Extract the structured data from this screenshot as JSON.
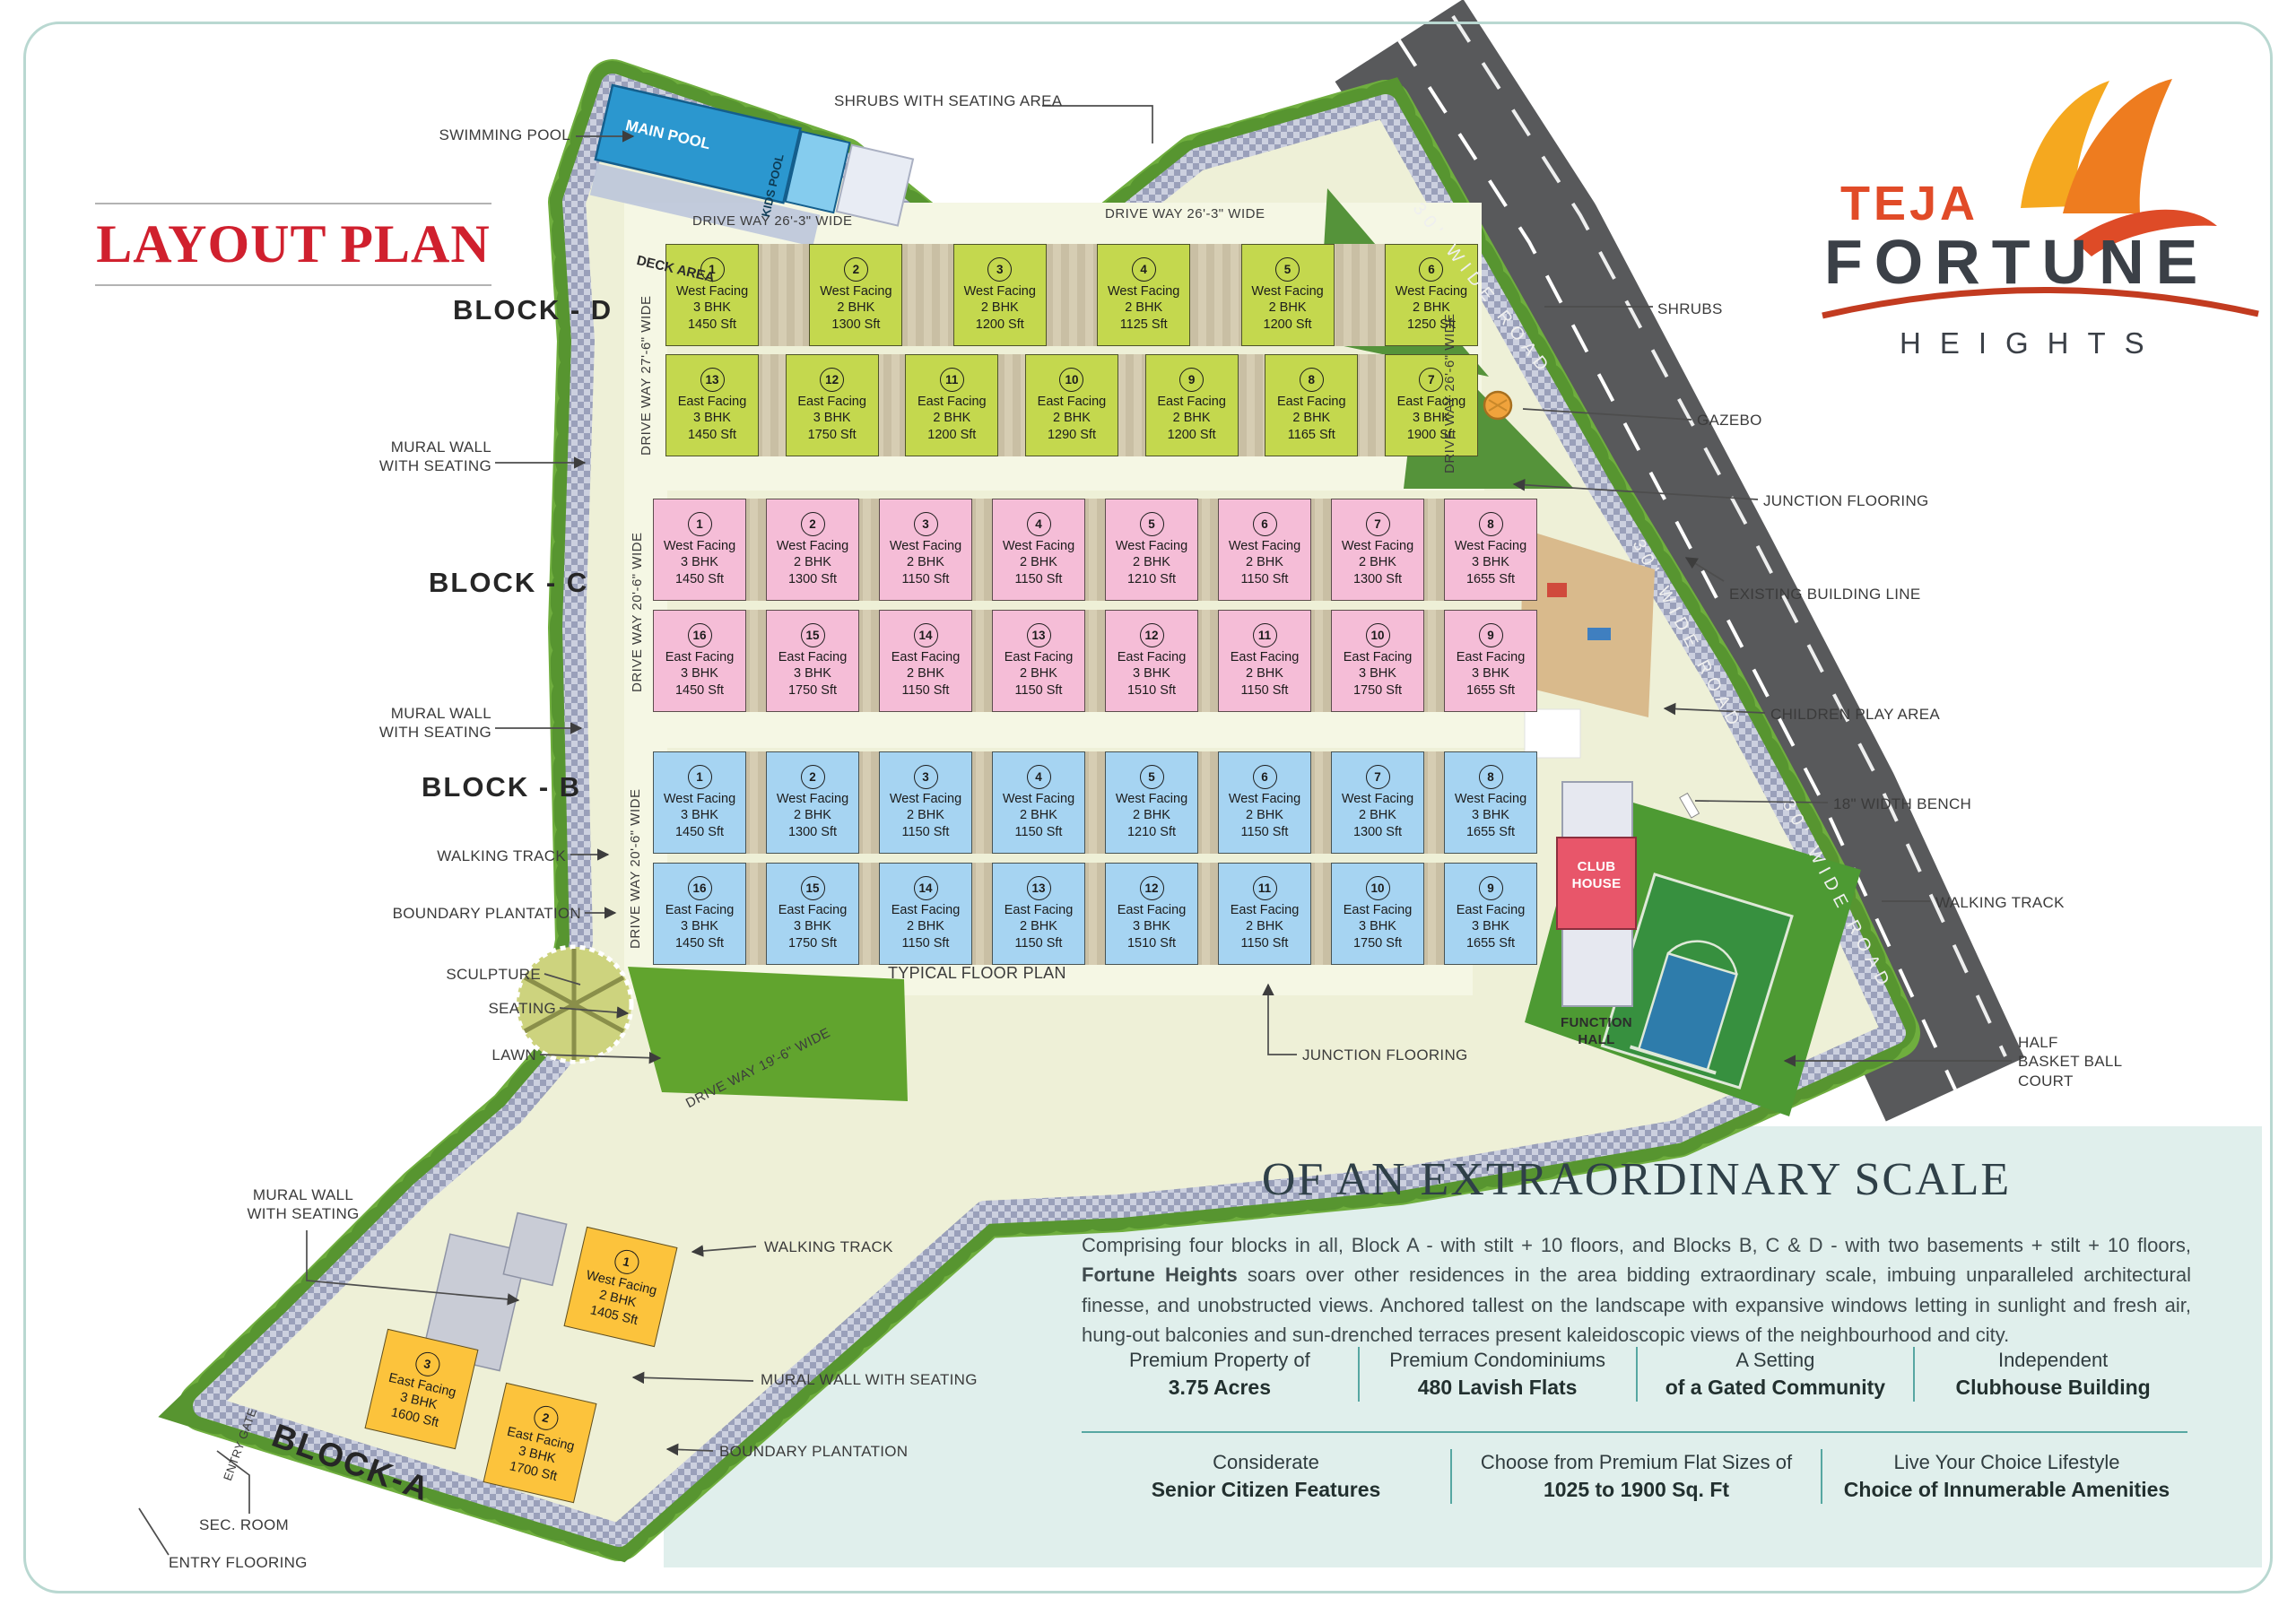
{
  "brand": {
    "teja": "TEJA",
    "fortune": "FORTUNE",
    "heights": "HEIGHTS"
  },
  "title": "LAYOUT PLAN",
  "pool": {
    "callout": "SWIMMING POOL",
    "main": "MAIN POOL",
    "kids": "KIDS POOL",
    "deck": "DECK AREA"
  },
  "driveways": {
    "top1": "DRIVE WAY 26'-3\" WIDE",
    "top2": "DRIVE WAY 26'-3\" WIDE",
    "d_left": "DRIVE WAY 27'-6\" WIDE",
    "d_right": "DRIVE WAY 26'-6\" WIDE",
    "c_left": "DRIVE WAY 20'-6\" WIDE",
    "b_left": "DRIVE WAY 20'-6\" WIDE",
    "bottom": "DRIVE WAY 19'-6\" WIDE"
  },
  "roads": {
    "r1": "30' WIDE ROAD",
    "r2": "30' WIDE ROAD",
    "r3": "30' WIDE ROAD"
  },
  "blocks": {
    "d": {
      "label": "BLOCK - D",
      "row1": [
        {
          "no": "1",
          "facing": "West Facing",
          "bhk": "3 BHK",
          "area": "1450 Sft"
        },
        {
          "no": "2",
          "facing": "West Facing",
          "bhk": "2 BHK",
          "area": "1300 Sft"
        },
        {
          "no": "3",
          "facing": "West Facing",
          "bhk": "2 BHK",
          "area": "1200 Sft"
        },
        {
          "no": "4",
          "facing": "West Facing",
          "bhk": "2 BHK",
          "area": "1125 Sft"
        },
        {
          "no": "5",
          "facing": "West Facing",
          "bhk": "2 BHK",
          "area": "1200 Sft"
        },
        {
          "no": "6",
          "facing": "West Facing",
          "bhk": "2 BHK",
          "area": "1250 Sft"
        }
      ],
      "row2": [
        {
          "no": "13",
          "facing": "East Facing",
          "bhk": "3 BHK",
          "area": "1450 Sft"
        },
        {
          "no": "12",
          "facing": "East Facing",
          "bhk": "3 BHK",
          "area": "1750 Sft"
        },
        {
          "no": "11",
          "facing": "East Facing",
          "bhk": "2 BHK",
          "area": "1200 Sft"
        },
        {
          "no": "10",
          "facing": "East Facing",
          "bhk": "2 BHK",
          "area": "1290 Sft"
        },
        {
          "no": "9",
          "facing": "East Facing",
          "bhk": "2 BHK",
          "area": "1200 Sft"
        },
        {
          "no": "8",
          "facing": "East Facing",
          "bhk": "2 BHK",
          "area": "1165 Sft"
        },
        {
          "no": "7",
          "facing": "East Facing",
          "bhk": "3 BHK",
          "area": "1900 Sft"
        }
      ]
    },
    "c": {
      "label": "BLOCK - C",
      "row1": [
        {
          "no": "1",
          "facing": "West Facing",
          "bhk": "3 BHK",
          "area": "1450 Sft"
        },
        {
          "no": "2",
          "facing": "West Facing",
          "bhk": "2 BHK",
          "area": "1300 Sft"
        },
        {
          "no": "3",
          "facing": "West Facing",
          "bhk": "2 BHK",
          "area": "1150 Sft"
        },
        {
          "no": "4",
          "facing": "West Facing",
          "bhk": "2 BHK",
          "area": "1150 Sft"
        },
        {
          "no": "5",
          "facing": "West Facing",
          "bhk": "2 BHK",
          "area": "1210 Sft"
        },
        {
          "no": "6",
          "facing": "West Facing",
          "bhk": "2 BHK",
          "area": "1150 Sft"
        },
        {
          "no": "7",
          "facing": "West Facing",
          "bhk": "2 BHK",
          "area": "1300 Sft"
        },
        {
          "no": "8",
          "facing": "West Facing",
          "bhk": "3 BHK",
          "area": "1655 Sft"
        }
      ],
      "row2": [
        {
          "no": "16",
          "facing": "East Facing",
          "bhk": "3 BHK",
          "area": "1450 Sft"
        },
        {
          "no": "15",
          "facing": "East Facing",
          "bhk": "3 BHK",
          "area": "1750 Sft"
        },
        {
          "no": "14",
          "facing": "East Facing",
          "bhk": "2 BHK",
          "area": "1150 Sft"
        },
        {
          "no": "13",
          "facing": "East Facing",
          "bhk": "2 BHK",
          "area": "1150 Sft"
        },
        {
          "no": "12",
          "facing": "East Facing",
          "bhk": "3 BHK",
          "area": "1510 Sft"
        },
        {
          "no": "11",
          "facing": "East Facing",
          "bhk": "2 BHK",
          "area": "1150 Sft"
        },
        {
          "no": "10",
          "facing": "East Facing",
          "bhk": "3 BHK",
          "area": "1750 Sft"
        },
        {
          "no": "9",
          "facing": "East Facing",
          "bhk": "3 BHK",
          "area": "1655 Sft"
        }
      ]
    },
    "b": {
      "label": "BLOCK - B",
      "row1": [
        {
          "no": "1",
          "facing": "West Facing",
          "bhk": "3 BHK",
          "area": "1450 Sft"
        },
        {
          "no": "2",
          "facing": "West Facing",
          "bhk": "2 BHK",
          "area": "1300 Sft"
        },
        {
          "no": "3",
          "facing": "West Facing",
          "bhk": "2 BHK",
          "area": "1150 Sft"
        },
        {
          "no": "4",
          "facing": "West Facing",
          "bhk": "2 BHK",
          "area": "1150 Sft"
        },
        {
          "no": "5",
          "facing": "West Facing",
          "bhk": "2 BHK",
          "area": "1210 Sft"
        },
        {
          "no": "6",
          "facing": "West Facing",
          "bhk": "2 BHK",
          "area": "1150 Sft"
        },
        {
          "no": "7",
          "facing": "West Facing",
          "bhk": "2 BHK",
          "area": "1300 Sft"
        },
        {
          "no": "8",
          "facing": "West Facing",
          "bhk": "3 BHK",
          "area": "1655 Sft"
        }
      ],
      "row2": [
        {
          "no": "16",
          "facing": "East Facing",
          "bhk": "3 BHK",
          "area": "1450 Sft"
        },
        {
          "no": "15",
          "facing": "East Facing",
          "bhk": "3 BHK",
          "area": "1750 Sft"
        },
        {
          "no": "14",
          "facing": "East Facing",
          "bhk": "2 BHK",
          "area": "1150 Sft"
        },
        {
          "no": "13",
          "facing": "East Facing",
          "bhk": "2 BHK",
          "area": "1150 Sft"
        },
        {
          "no": "12",
          "facing": "East Facing",
          "bhk": "3 BHK",
          "area": "1510 Sft"
        },
        {
          "no": "11",
          "facing": "East Facing",
          "bhk": "2 BHK",
          "area": "1150 Sft"
        },
        {
          "no": "10",
          "facing": "East Facing",
          "bhk": "3 BHK",
          "area": "1750 Sft"
        },
        {
          "no": "9",
          "facing": "East Facing",
          "bhk": "3 BHK",
          "area": "1655 Sft"
        }
      ]
    },
    "a": {
      "label": "BLOCK-A",
      "units": [
        {
          "no": "1",
          "facing": "West Facing",
          "bhk": "2 BHK",
          "area": "1405 Sft"
        },
        {
          "no": "3",
          "facing": "East Facing",
          "bhk": "3 BHK",
          "area": "1600 Sft"
        },
        {
          "no": "2",
          "facing": "East Facing",
          "bhk": "3 BHK",
          "area": "1700 Sft"
        }
      ]
    }
  },
  "callouts": {
    "swimming_pool": "SWIMMING POOL",
    "shrubs_seating": "SHRUBS WITH SEATING AREA",
    "mural_d": "MURAL WALL\nWITH SEATING",
    "mural_c": "MURAL WALL\nWITH SEATING",
    "walking_left": "WALKING TRACK",
    "boundary_left": "BOUNDARY PLANTATION",
    "sculpture": "SCULPTURE",
    "seating": "SEATING",
    "lawn": "LAWN",
    "mural_bottom": "MURAL WALL\nWITH SEATING",
    "walking_a": "WALKING TRACK",
    "mural_a": "MURAL WALL WITH SEATING",
    "boundary_a": "BOUNDARY PLANTATION",
    "sec_room": "SEC. ROOM",
    "entry_flooring": "ENTRY FLOORING",
    "entry_gate": "ENTRY GATE",
    "shrubs": "SHRUBS",
    "gazebo": "GAZEBO",
    "junction_top": "JUNCTION FLOORING",
    "existing_line": "EXISTING BUILDING LINE",
    "children": "CHILDREN PLAY AREA",
    "bench": "18\" WIDTH BENCH",
    "walking_right": "WALKING TRACK",
    "basketball": "HALF\nBASKET BALL\nCOURT",
    "typical": "TYPICAL FLOOR PLAN",
    "junction_bottom": "JUNCTION FLOORING",
    "club_house": "CLUB\nHOUSE",
    "function_hall": "FUNCTION\nHALL"
  },
  "panel": {
    "heading": "OF AN EXTRAORDINARY SCALE",
    "para_1": "Comprising four blocks in all, Block A - with stilt + 10 floors, and Blocks B, C & D - with two basements + stilt + 10 floors, ",
    "para_bold": "Fortune Heights",
    "para_2": " soars over other residences in the area bidding extraordinary scale, imbuing unparalleled architectural finesse, and unobstructed views. Anchored tallest on the landscape with expansive windows letting in sunlight and fresh air, hung-out balconies and sun-drenched terraces present kaleidoscopic views of the neighbourhood and city.",
    "stats_row1": [
      {
        "l1": "Premium Property of",
        "l2": "3.75 Acres"
      },
      {
        "l1": "Premium Condominiums",
        "l2": "480 Lavish Flats"
      },
      {
        "l1": "A Setting",
        "l2": "of a Gated Community"
      },
      {
        "l1": "Independent",
        "l2": "Clubhouse Building"
      }
    ],
    "stats_row2": [
      {
        "l1": "Considerate",
        "l2": "Senior Citizen Features"
      },
      {
        "l1": "Choose from Premium Flat Sizes of",
        "l2": "1025 to 1900 Sq. Ft"
      },
      {
        "l1": "Live Your Choice Lifestyle",
        "l2": "Choice of Innumerable Amenities"
      }
    ]
  },
  "colors": {
    "accent_red": "#d0202e",
    "block_d": "#c4d84e",
    "block_c": "#f5bdd7",
    "block_b": "#a6d4f2",
    "block_a": "#fcc33c",
    "road": "#58595b",
    "panel": "#e0efec",
    "teal": "#57a7a2",
    "clubhouse": "#e8566a",
    "ground": "#eef0d7",
    "paving": "#9aa0ba",
    "green": "#6fae3e",
    "pool": "#2b97cf"
  }
}
